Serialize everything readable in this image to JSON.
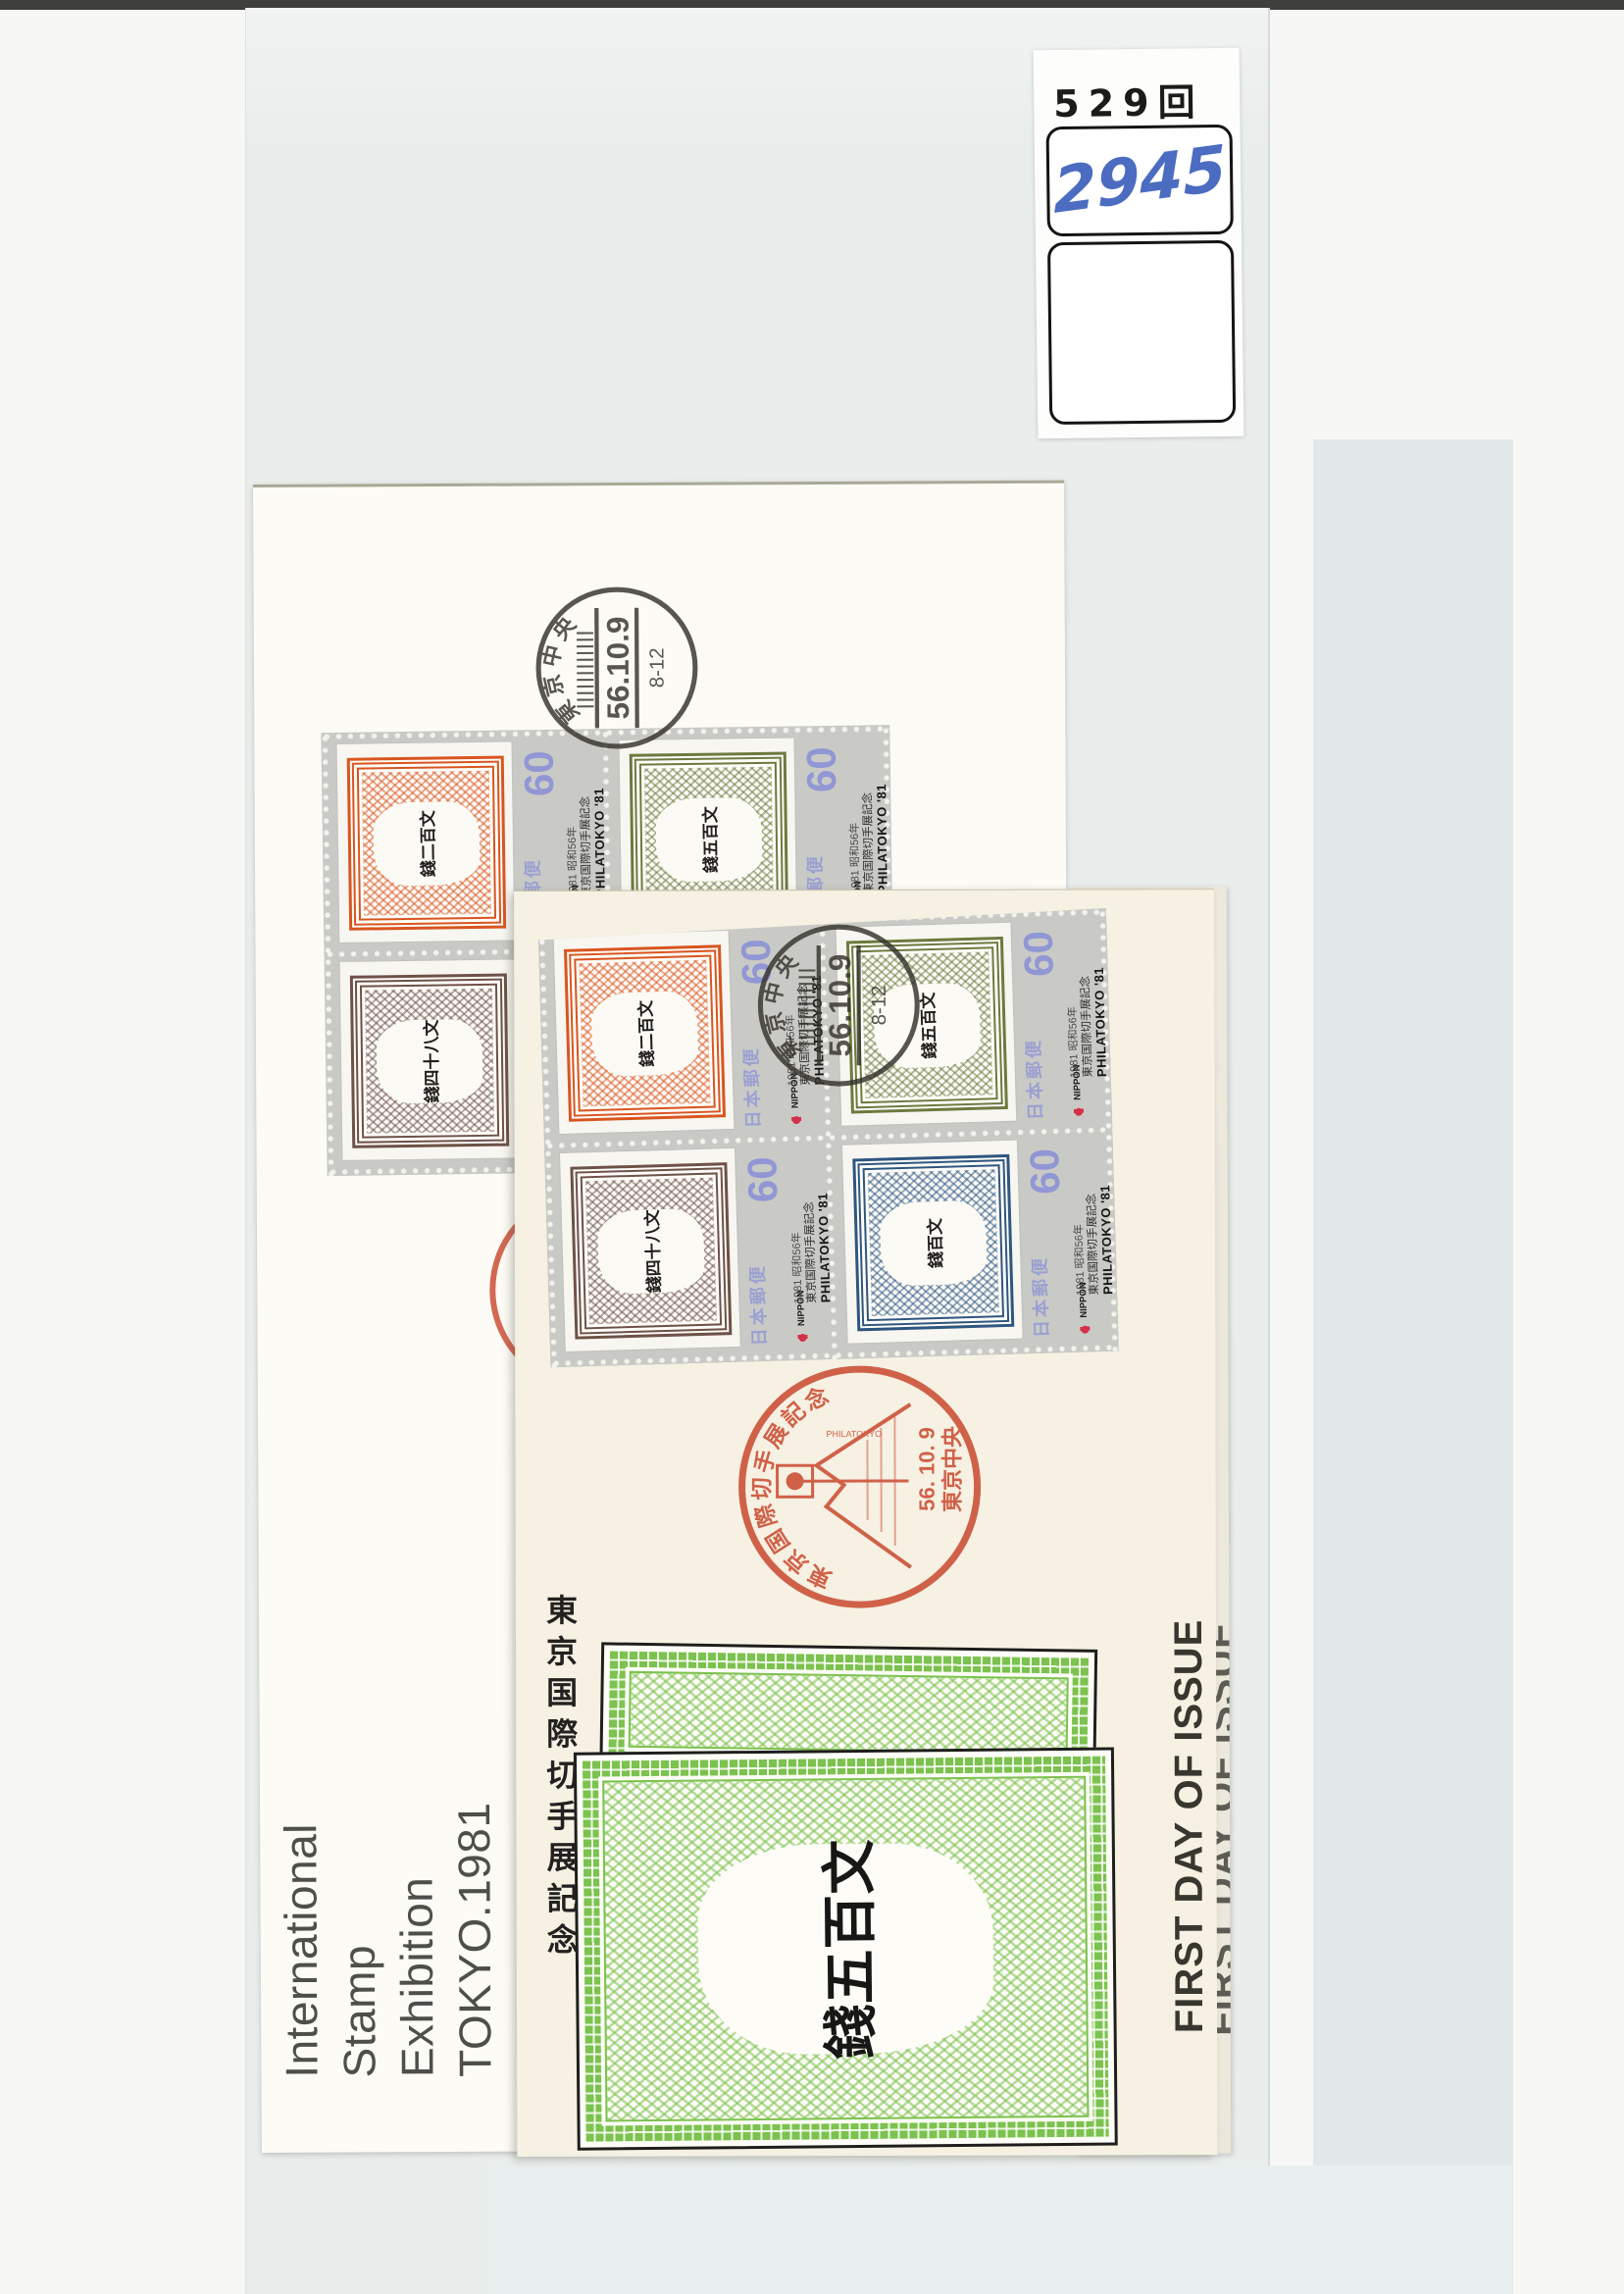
{
  "label_card": {
    "exhibition_number": "529回",
    "handwritten_number": "2945"
  },
  "postmark_black": {
    "office": "東京中央",
    "date": "56.10.9",
    "time_range": "8-12"
  },
  "commemorative_cancel": {
    "arc_text": "東京国際切手展記念",
    "small_text": "PHILATOKYO",
    "date": "56. 10. 9",
    "office": "東京中央"
  },
  "stamp_unit": {
    "denomination": "60",
    "year_line": "1981 昭和56年",
    "exhibition_line": "東京国際切手展記念",
    "brand_line": "PHILATOKYO '81",
    "postal_service": "日本郵便",
    "country": "NIPPON"
  },
  "stamps": [
    {
      "name": "orange-200mon",
      "color": "#d9551f",
      "color_soft": "rgba(217,85,31,0.5)",
      "kanji": "錢二百文"
    },
    {
      "name": "green-500mon",
      "color": "#6c7a3f",
      "color_soft": "rgba(108,122,63,0.5)",
      "kanji": "錢五百文"
    },
    {
      "name": "brown-48mon",
      "color": "#6e5147",
      "color_soft": "rgba(110,81,71,0.5)",
      "kanji": "錢四十八文"
    },
    {
      "name": "blue-100mon",
      "color": "#2e567f",
      "color_soft": "rgba(46,86,127,0.5)",
      "kanji": "錢百文"
    }
  ],
  "upper_cover": {
    "footer_lines": [
      "International",
      "Stamp",
      "Exhibition",
      "TOKYO.1981"
    ]
  },
  "lower_cover": {
    "first_day_text": "FIRST DAY OF ISSUE",
    "cachet": {
      "side_text": "東京国際切手展記念",
      "center_kanji": "錢五百文",
      "color": "#7cc24e"
    }
  },
  "colors": {
    "sleeve": "#e9edec",
    "upper_cover": "#fcfbf5",
    "lower_cover": "#f6f1e2",
    "black_ink": "#35322b",
    "red_ink": "#cb4e35",
    "denomination_purple": "#9196d4",
    "handwriting_blue": "#4b6cc1"
  }
}
